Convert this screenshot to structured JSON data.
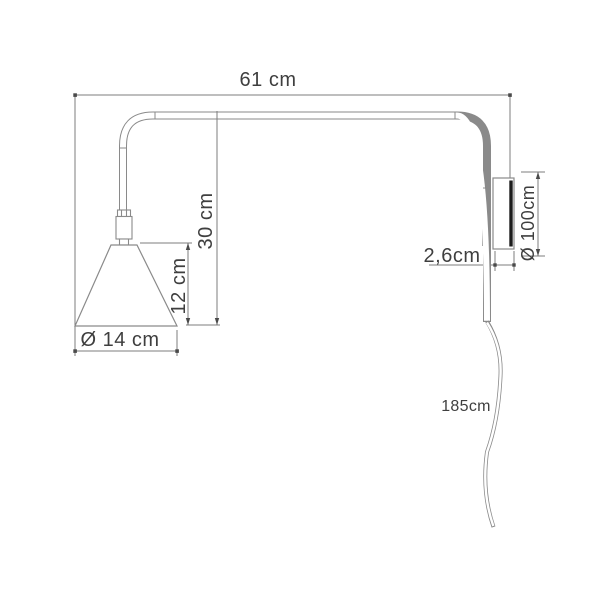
{
  "diagram": {
    "type": "technical-dimension-drawing",
    "subject": "wall-mounted swing-arm lamp, side view",
    "dimensions": {
      "arm_length": "61 cm",
      "drop_height": "30 cm",
      "shade_height": "12 cm",
      "shade_diameter": "Ø 14 cm",
      "plate_thickness": "2,6cm",
      "plate_height": "Ø 100cm",
      "cable_length": "185cm"
    },
    "colors": {
      "background": "#ffffff",
      "tube_line": "#8a8a8a",
      "dimension_line": "#7d7d7d",
      "text": "#3f3f3f",
      "plate_face": "#1d1d1d"
    }
  }
}
